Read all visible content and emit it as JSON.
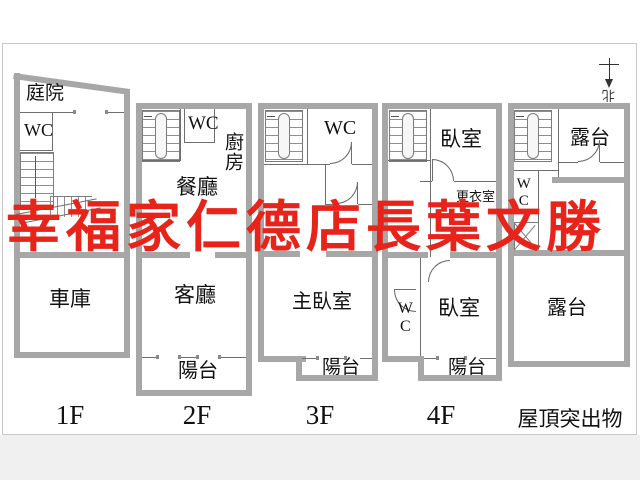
{
  "watermark": {
    "text": "幸福家仁德店長葉文勝",
    "color": "#e8231a"
  },
  "compass": {
    "north_label": "北"
  },
  "palette": {
    "wall": "#a7a7a7",
    "thin_line": "#6e6e6e",
    "text": "#111111",
    "frame_border": "#c9c9c9",
    "watermark_red": "#e8231a"
  },
  "floors": {
    "f1": {
      "label": "1F",
      "rooms": {
        "courtyard": "庭院",
        "wc": "WC",
        "garage": "車庫"
      }
    },
    "f2": {
      "label": "2F",
      "rooms": {
        "wc": "WC",
        "kitchen": "廚房",
        "dining": "餐廳",
        "living": "客廳",
        "balcony": "陽台"
      }
    },
    "f3": {
      "label": "3F",
      "rooms": {
        "wc": "WC",
        "master_bedroom": "主臥室",
        "balcony": "陽台"
      }
    },
    "f4": {
      "label": "4F",
      "rooms": {
        "bedroom_upper": "臥室",
        "closet": "更衣室",
        "wc": "WC",
        "bedroom_lower": "臥室",
        "balcony": "陽台"
      }
    },
    "rf": {
      "label": "屋頂突出物",
      "rooms": {
        "terrace_upper": "露台",
        "wc": "WC",
        "terrace_lower": "露台"
      }
    }
  }
}
